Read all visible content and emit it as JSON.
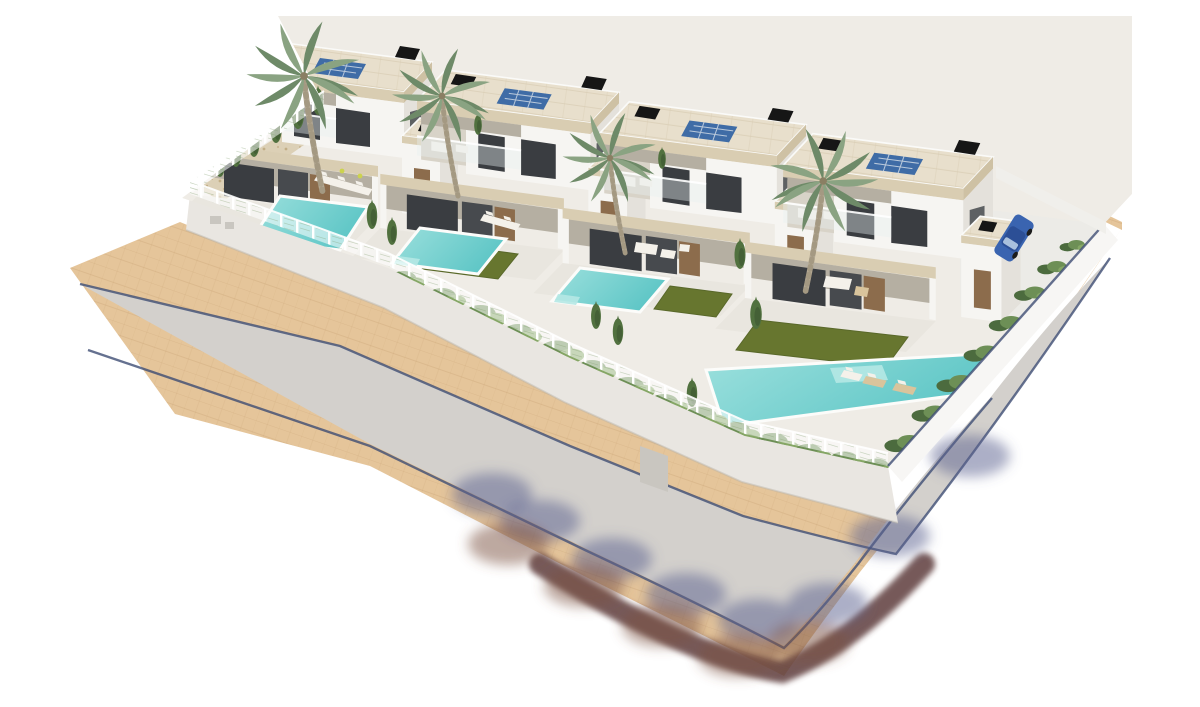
{
  "meta": {
    "title": "New-build villa development — aerial 3D architectural render",
    "alt": "Aerial 3D architectural rendering on a white background showing a new-build development of four modern white two-storey villas with flat roofs, beige fascia bands, rooftop solar panels and black chimneys. Each villa has a private turquoise swimming pool, artificial lawn, gravel beds, cypress trees and tall palm trees inside white fenced gardens. A gray asphalt street with sand-coloured paved sidewalks and a dark curb gutter line sweeps from the left edge around the bottom corner up to the right tip, with blue and maroon tree shadows cast across the bend. A blue car is parked in the driveway of the right-most villa beside a white perimeter wall."
  },
  "scene": {
    "villas": [
      {
        "id": "villa-1",
        "features": [
          "flat-roof",
          "solar-panel",
          "chimney",
          "roof-terrace",
          "glass-balustrade",
          "covered-terrace"
        ]
      },
      {
        "id": "villa-2",
        "features": [
          "flat-roof",
          "solar-panel",
          "chimney",
          "roof-terrace",
          "glass-balustrade",
          "covered-terrace"
        ]
      },
      {
        "id": "villa-3",
        "features": [
          "flat-roof",
          "solar-panel",
          "chimney",
          "roof-terrace",
          "glass-balustrade",
          "covered-terrace"
        ]
      },
      {
        "id": "villa-4",
        "features": [
          "flat-roof",
          "solar-panel",
          "chimney",
          "roof-terrace",
          "glass-balustrade",
          "covered-terrace",
          "carport"
        ]
      }
    ],
    "pools": [
      {
        "id": "pool-1",
        "shape": "rectangular"
      },
      {
        "id": "pool-2",
        "shape": "rectangular"
      },
      {
        "id": "pool-3",
        "shape": "rectangular"
      },
      {
        "id": "pool-4",
        "shape": "rectangular-with-step"
      }
    ],
    "palm_trees": [
      {
        "id": "palm-1"
      },
      {
        "id": "palm-2"
      },
      {
        "id": "palm-3"
      },
      {
        "id": "palm-4"
      }
    ],
    "vehicles": [
      {
        "id": "car-1",
        "color_name": "blue"
      }
    ],
    "street": {
      "surfaces": [
        "asphalt-road",
        "paved-sidewalks"
      ],
      "features": [
        "curb-gutter-line",
        "tree-shadows-on-pavement",
        "corner-bend"
      ]
    },
    "landscaping": [
      "cypress-trees",
      "hedges",
      "gravel-beds",
      "artificial-lawns",
      "white-mesh-fence",
      "perimeter-walls"
    ]
  },
  "colors": {
    "page-bg": "#ffffff",
    "platform": "#efece6",
    "wall-front": "#e9e6e1",
    "wall-right": "#f7f6f4",
    "wall-back": "#f0efeb",
    "sidewalk": "#e5c59a",
    "sidewalk-line": "#c8a273",
    "asphalt": "#d3d0cc",
    "gutter": "#3e4e74",
    "shadow-blue": "#5a6090",
    "shadow-maroon": "#7c5143",
    "shadow-dark": "#5e3e3e",
    "roof": "#e8dfcc",
    "roof-line": "#d9cdb4",
    "fascia": "#d9cdb2",
    "fascia-side": "#cec1a4",
    "wall-lit": "#f6f5f2",
    "wall-side": "#e4e1db",
    "terrace-back": "#d8d3c8",
    "soffit": "#b5afa2",
    "glass": "#3a3d41",
    "glass2": "#474a4e",
    "wood": "#8c6c4c",
    "slab": "#e9e6df",
    "chimney": "#161616",
    "solar": "#3f6ca6",
    "solar-frame": "#d7dfe8",
    "pool-deep": "#5ec6c6",
    "pool-light": "#9ce0dd",
    "pool-step": "#b5e8e4",
    "pool-edge": "#fcfcfa",
    "lawn": "#67762f",
    "lawn-edge": "#59682a",
    "gravel": "#dcd0b6",
    "gravel-dot": "#c2ae86",
    "hedge-dark": "#4c6b3e",
    "hedge-mid": "#6d8f56",
    "hedge-light": "#85a665",
    "cypress": "#51713f",
    "cypress-dark": "#3f5a33",
    "palm-frond": "#8aa382",
    "palm-frond-dark": "#6e8a68",
    "palm-trunk": "#b3a893",
    "palm-trunk-dark": "#988c74",
    "furniture-white": "#f4f1ea",
    "furniture-tan": "#d9c49c",
    "accent-yellow": "#ccd34e",
    "car-body": "#3a64b0",
    "car-roof": "#2c4f96",
    "car-glass": "#a9c0dd",
    "driveway": "#ecebe7"
  }
}
